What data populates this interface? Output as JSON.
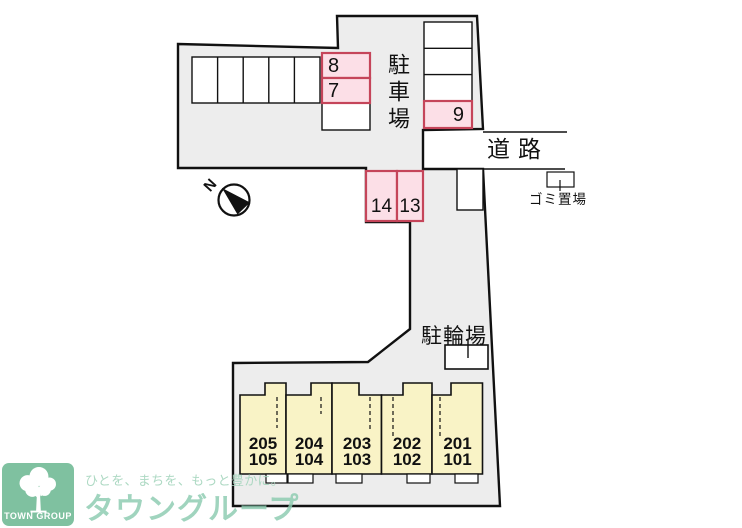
{
  "map": {
    "parking_label": "駐車場",
    "road_label": "道路",
    "garbage_label": "ゴミ置場",
    "bicycle_label": "駐輪場",
    "compass_label": "N",
    "spaces": {
      "s8": "8",
      "s7": "7",
      "s9": "9",
      "s14": "14",
      "s13": "13"
    }
  },
  "building": {
    "units": [
      {
        "upper": "205",
        "lower": "105"
      },
      {
        "upper": "204",
        "lower": "104"
      },
      {
        "upper": "203",
        "lower": "103"
      },
      {
        "upper": "202",
        "lower": "102"
      },
      {
        "upper": "201",
        "lower": "101"
      }
    ]
  },
  "branding": {
    "logo_text": "TOWN GROUP",
    "slogan": "ひとを、まちを、もっと豊かに。",
    "brand_name": "タウングループ"
  },
  "colors": {
    "site_fill": "#ededed",
    "pink_space_fill": "#fcdfe7",
    "pink_space_border": "#c5455a",
    "unit_fill": "#f9f3c6",
    "logo_green": "#7fc1a0",
    "watermark_green": "#8ccbb0"
  }
}
